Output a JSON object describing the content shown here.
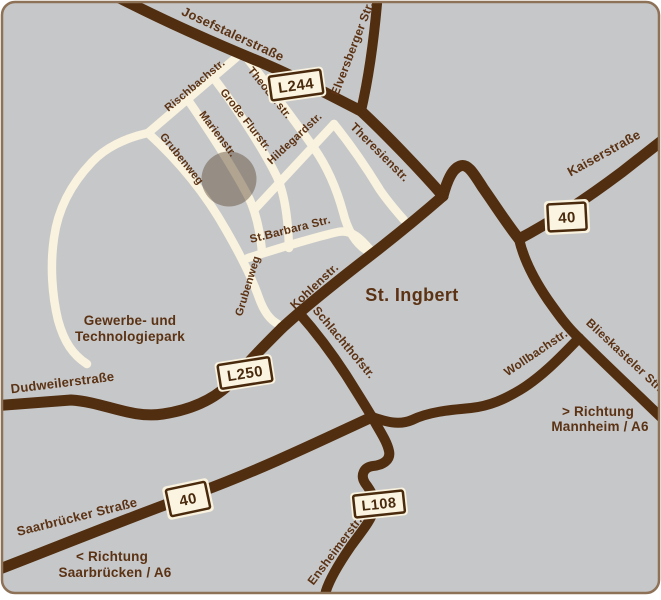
{
  "map": {
    "town": "St. Ingbert",
    "streets": {
      "josefstalerstrasse": "Josefstalerstraße",
      "elversberger_str": "Elversberger Str.",
      "theresienstr": "Theresienstr.",
      "kaiserstrasse": "Kaiserstraße",
      "rischbachstr": "Rischbachstr.",
      "theodorstr": "Theodorstr.",
      "grosse_flurstr": "Große Flurstr.",
      "marienstr": "Marienstr.",
      "hildegardstr": "Hildegardstr.",
      "grubenweg_upper": "Grubenweg",
      "grubenweg_lower": "Grubenweg",
      "st_barbara_str": "St.Barbara Str.",
      "kohlenstr": "Kohlenstr.",
      "schlachthofstr": "Schlachthofstr.",
      "wollbachstr": "Wollbachstr.",
      "blieskasteler_str": "Blieskasteler Str.",
      "dudweilerstrasse": "Dudweilerstraße",
      "saarbruecker_strasse": "Saarbrücker Straße",
      "ensheimerstr": "Ensheimerstr."
    },
    "areas": {
      "park_line1": "Gewerbe- und",
      "park_line2": "Technologiepark"
    },
    "directions": {
      "mannheim_line1": "> Richtung",
      "mannheim_line2": "Mannheim / A6",
      "saarbruecken_line1": "< Richtung",
      "saarbruecken_line2": "Saarbrücken / A6"
    },
    "road_badges": {
      "l244": "L244",
      "a40_east": "40",
      "l250": "L250",
      "a40_west": "40",
      "l108": "L108"
    },
    "colors": {
      "background": "#c6c7c9",
      "major_road": "#512e0f",
      "minor_road": "#f8f2de",
      "label_text": "#5b3213",
      "badge_fill": "#faf4e1",
      "badge_border": "#4a2a0d",
      "frame_border": "#8d7258",
      "marker_fill": "rgba(92,70,50,0.45)"
    }
  }
}
